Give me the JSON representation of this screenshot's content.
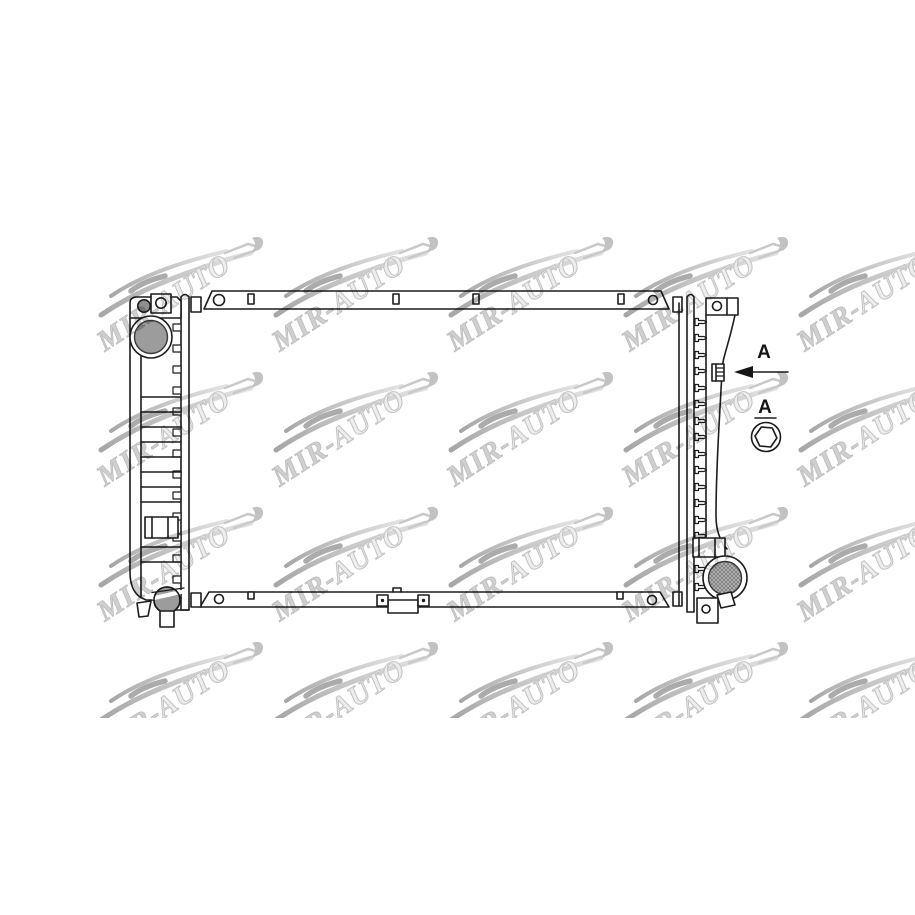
{
  "watermark": {
    "text_primary": "MIR-",
    "text_secondary": "AUTO"
  },
  "annotations": {
    "arrow_label": "A",
    "detail_label": "A"
  },
  "colors": {
    "background": "#ffffff",
    "line": "#1c1c1c",
    "filler_cap_gray": "#9c9c9c",
    "drain_plug_gray": "#9c9c9c",
    "pin_circle_gray": "#8e8e8e",
    "hatch_base_gray": "#b7b7b7",
    "hatch_line_gray": "#7a7a7a",
    "watermark_gray": "#c6c6c6"
  }
}
